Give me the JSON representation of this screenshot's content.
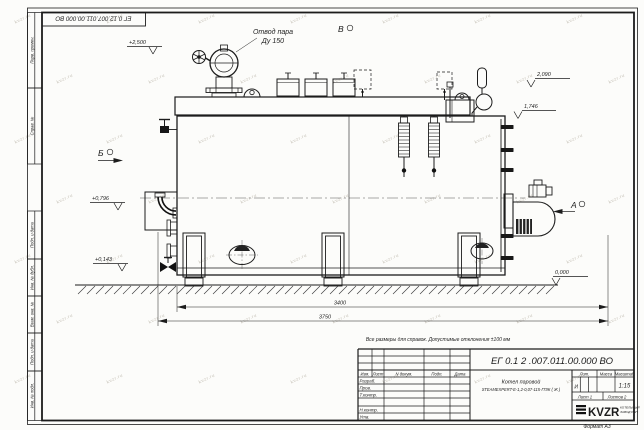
{
  "meta": {
    "format_label": "Формат А3",
    "watermark": "kvzr.ru"
  },
  "frame": {
    "stamps": [
      "Перв. примен.",
      "Справ. №",
      "Подп. и дата",
      "Инв. № дубл.",
      "Взам. инв. №",
      "Подп. и дата",
      "Инв. № подл."
    ]
  },
  "top_stamp": {
    "number": "ЕГ 0.12.007.011.00.000  ВО"
  },
  "drawing": {
    "callouts": {
      "steam_outlet_line1": "Отвод пара",
      "steam_outlet_line2": "Ду 150"
    },
    "views": [
      {
        "label": "Б"
      },
      {
        "label": "В"
      },
      {
        "label": "А"
      }
    ],
    "elevations": [
      "+2,500",
      "2,090",
      "1,746",
      "+0,796",
      "+0,143",
      "0,000"
    ],
    "dimensions": [
      "3400",
      "3750"
    ],
    "note": "Все размеры для справок. Допустимые отклонения ±100 мм"
  },
  "title_block": {
    "number": "ЕГ 0.1 2 .007.011.00.000  ВО",
    "rev_header": {
      "izm": "Изм.",
      "list": "Лист",
      "doc": "N докум.",
      "sign": "Подп.",
      "date": "Дата"
    },
    "rows": [
      "Разраб.",
      "Пров.",
      "Т.контр.",
      "Н.контр.",
      "Утв."
    ],
    "name_line1": "Котел паровой",
    "name_line2": "STEAMEXPERT-Е-1,2-0,07-115-ГПЖ ( Ж )",
    "lit_label": "Лит.",
    "lit_value": "И",
    "mass_label": "Масса",
    "scale_label": "Масштаб",
    "scale_value": "1:15",
    "sheet_label": "Лист 1",
    "sheets_label": "Листов 2",
    "logo_text": "KVZR",
    "logo_sub1": "КОТЕЛЬНЫЙ",
    "logo_sub2": "ЗАВОД РЭП"
  }
}
